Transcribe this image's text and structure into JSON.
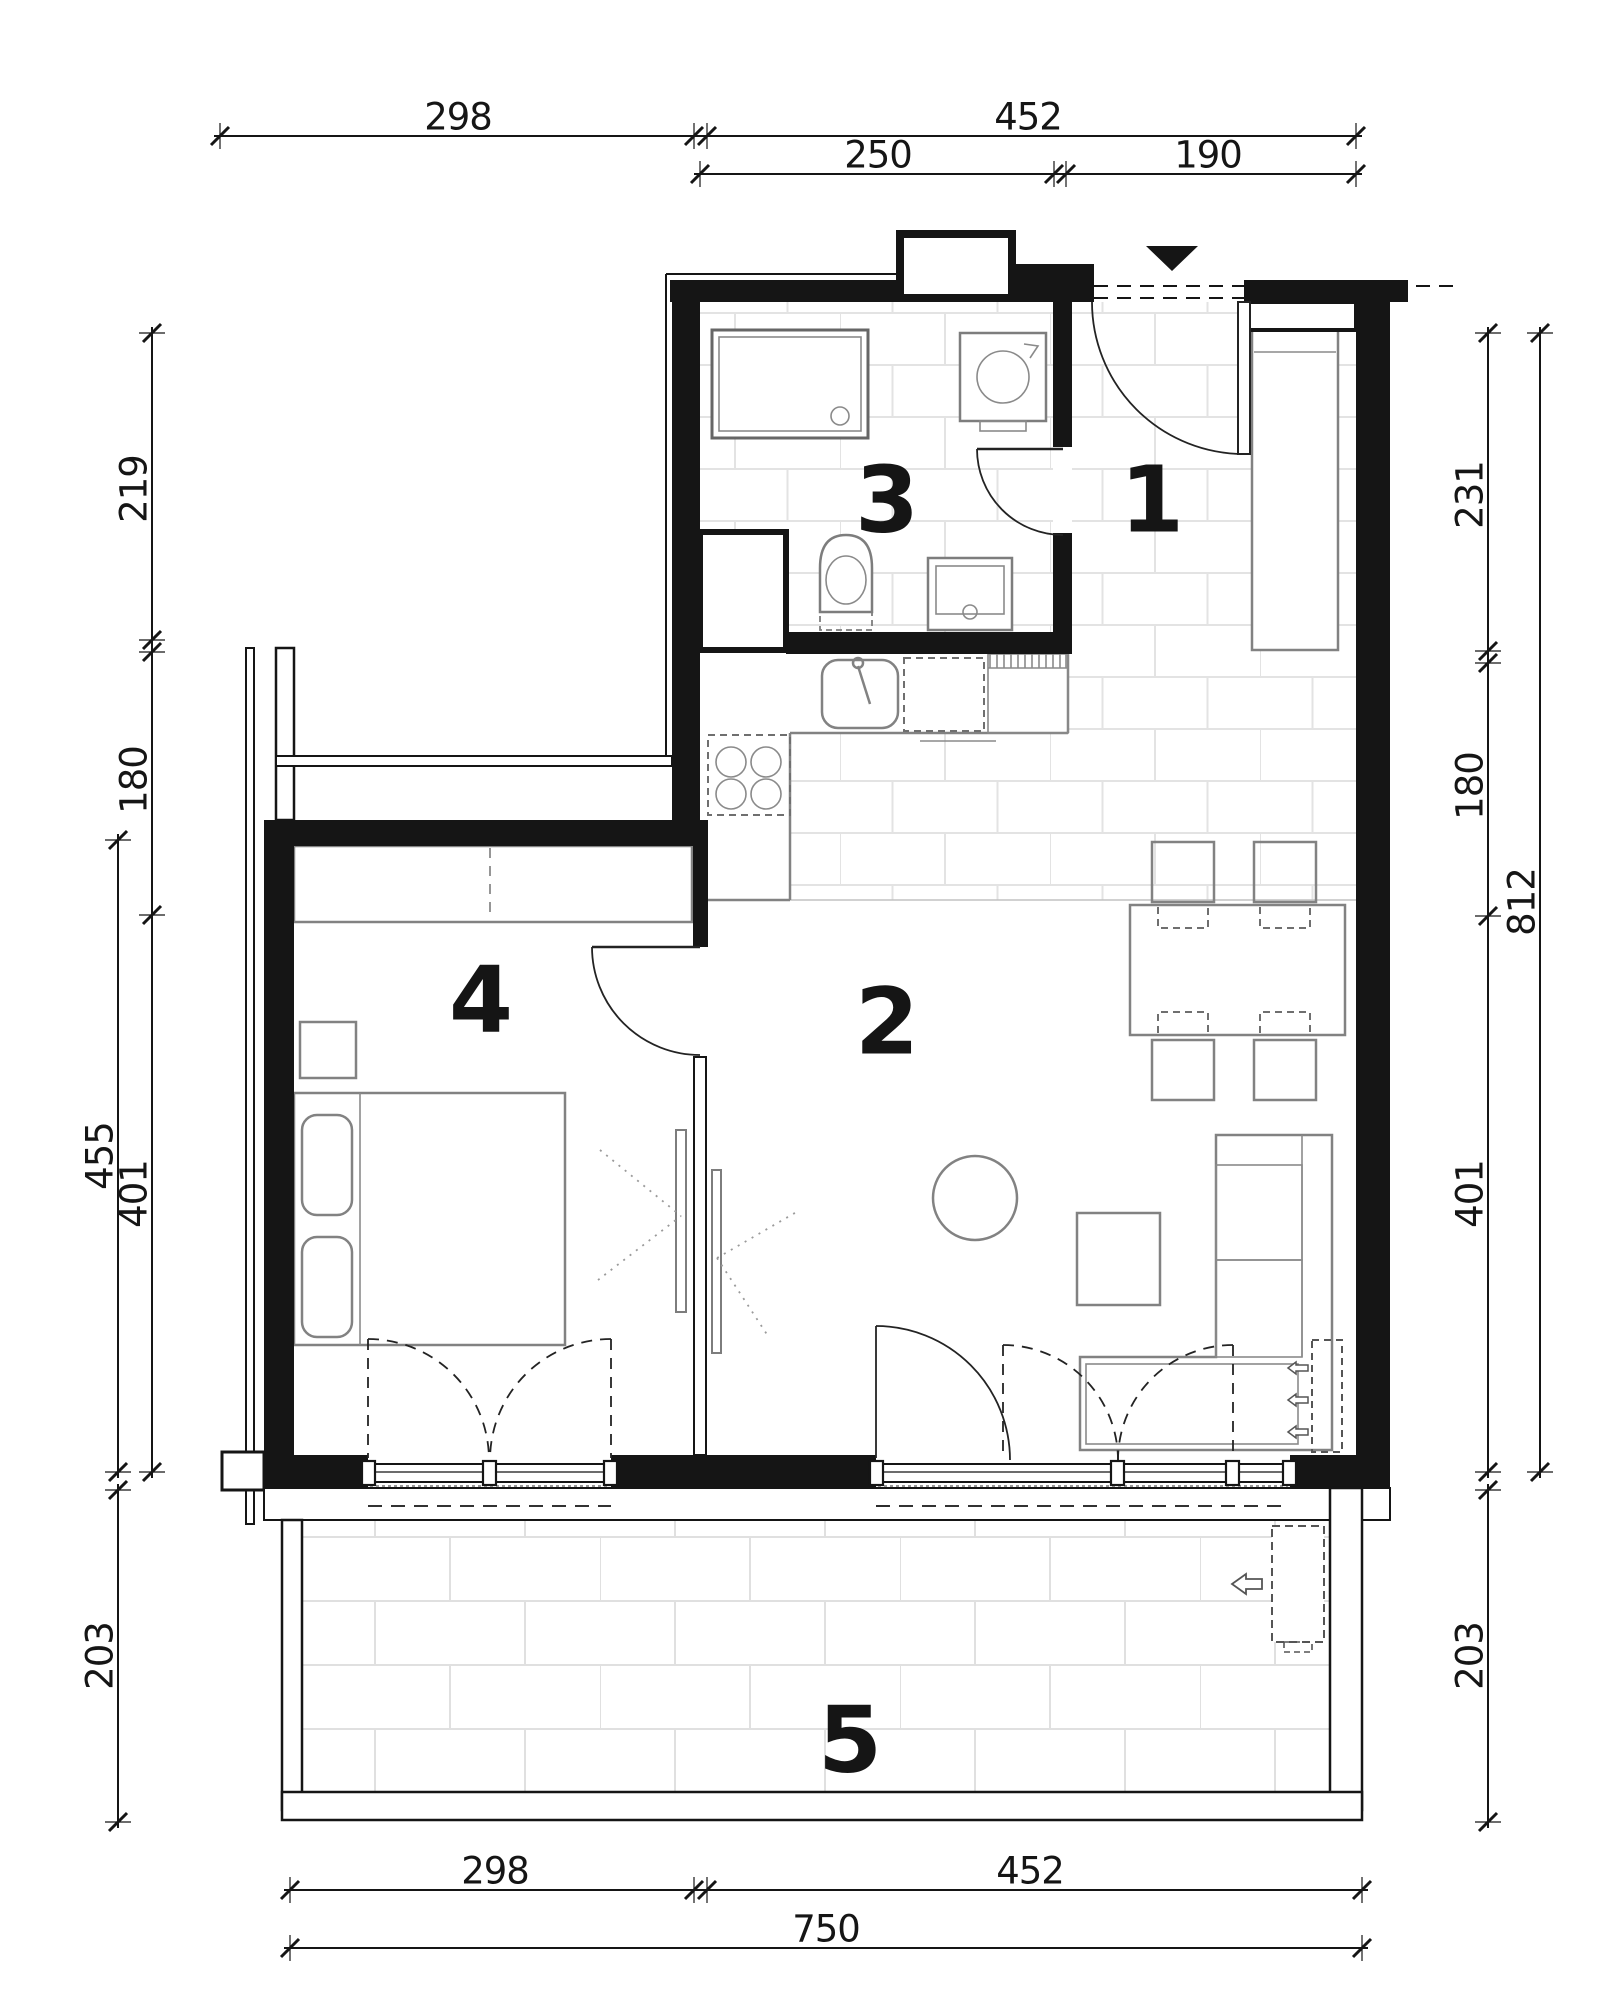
{
  "rooms": {
    "hall": "1",
    "living_room": "2",
    "bathroom": "3",
    "bedroom": "4",
    "terrace": "5"
  },
  "dimensions": {
    "top": {
      "seg_left": "298",
      "seg_right": "452",
      "sub_left": "250",
      "sub_right": "190"
    },
    "left": {
      "seg1": "219",
      "seg2": "180",
      "outer": "455",
      "seg3": "401",
      "terrace": "203"
    },
    "right": {
      "seg1": "231",
      "seg2": "180",
      "outer": "812",
      "seg3": "401",
      "terrace": "203"
    },
    "bottom": {
      "seg_left": "298",
      "seg_right": "452",
      "total": "750"
    }
  },
  "icons": {
    "entrance_marker": "entrance-triangle-down",
    "washing_machine": "rotating-drum-arrow",
    "radiator": "dashed-radiator-with-flow-arrows"
  },
  "colors": {
    "ink": "#151515",
    "furniture": "#828282",
    "tile": "#e3e3e3"
  }
}
